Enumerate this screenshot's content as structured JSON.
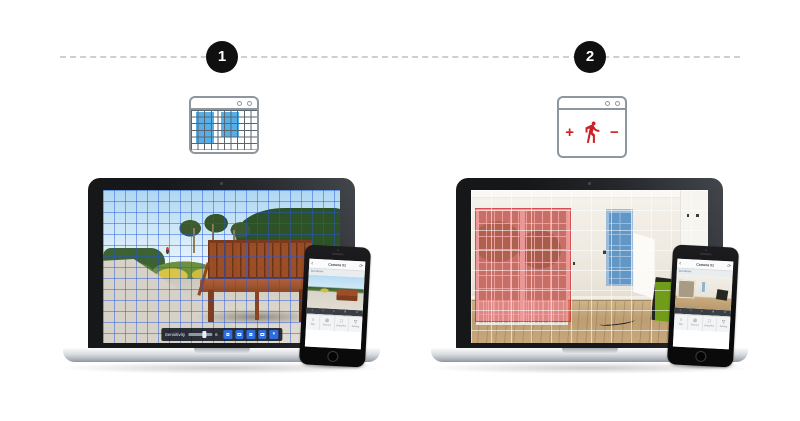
{
  "page": {
    "background_color": "#ffffff",
    "timeline_color": "#cfcfcf"
  },
  "steps": [
    {
      "number": "1",
      "badge_color": "#101010",
      "icon": {
        "name": "browser-window-grid-zones",
        "zone_color": "#55b0ea"
      },
      "laptop": {
        "scene": "park walkway with wooden bench under blue motion-detection grid",
        "grid_color": "#2556d8",
        "toolbar": {
          "label": "Sensitivity",
          "value": "6",
          "dropdown_glyph": "▾",
          "button_color": "#2e6de0"
        }
      },
      "phone": {
        "header": {
          "back_glyph": "‹",
          "title": "Camera 01",
          "action_glyph": "⟳"
        },
        "subbar_label": "Set Motion",
        "strip_glyphs": [
          "‹",
          "›",
          "▪",
          "≡",
          "×"
        ],
        "buttons": [
          {
            "icon_glyph": "○",
            "label": "Talk"
          },
          {
            "icon_glyph": "◎",
            "label": "Record"
          },
          {
            "icon_glyph": "□",
            "label": "Snapshot"
          },
          {
            "icon_glyph": "▽",
            "label": "Setting"
          }
        ]
      }
    },
    {
      "number": "2",
      "badge_color": "#101010",
      "icon": {
        "name": "browser-window-person-plus-minus",
        "plus": "+",
        "minus": "−",
        "color": "#cc2127"
      },
      "laptop": {
        "scene": "empty room with highlighted motion zones under white grid",
        "grid_color": "#ffffff",
        "zones": [
          {
            "name": "red-zone",
            "color": "#ec3e42"
          },
          {
            "name": "blue-zone",
            "color": "#4a8ac8"
          },
          {
            "name": "green-zone",
            "color": "#8bc41a"
          }
        ]
      },
      "phone": {
        "header": {
          "back_glyph": "‹",
          "title": "Camera 01",
          "action_glyph": "⟳"
        },
        "subbar_label": "Set Motion",
        "strip_glyphs": [
          "‹",
          "›",
          "▪",
          "≡",
          "×"
        ],
        "buttons": [
          {
            "icon_glyph": "○",
            "label": "Talk"
          },
          {
            "icon_glyph": "◎",
            "label": "Record"
          },
          {
            "icon_glyph": "□",
            "label": "Snapshot"
          },
          {
            "icon_glyph": "▽",
            "label": "Setting"
          }
        ]
      }
    }
  ]
}
